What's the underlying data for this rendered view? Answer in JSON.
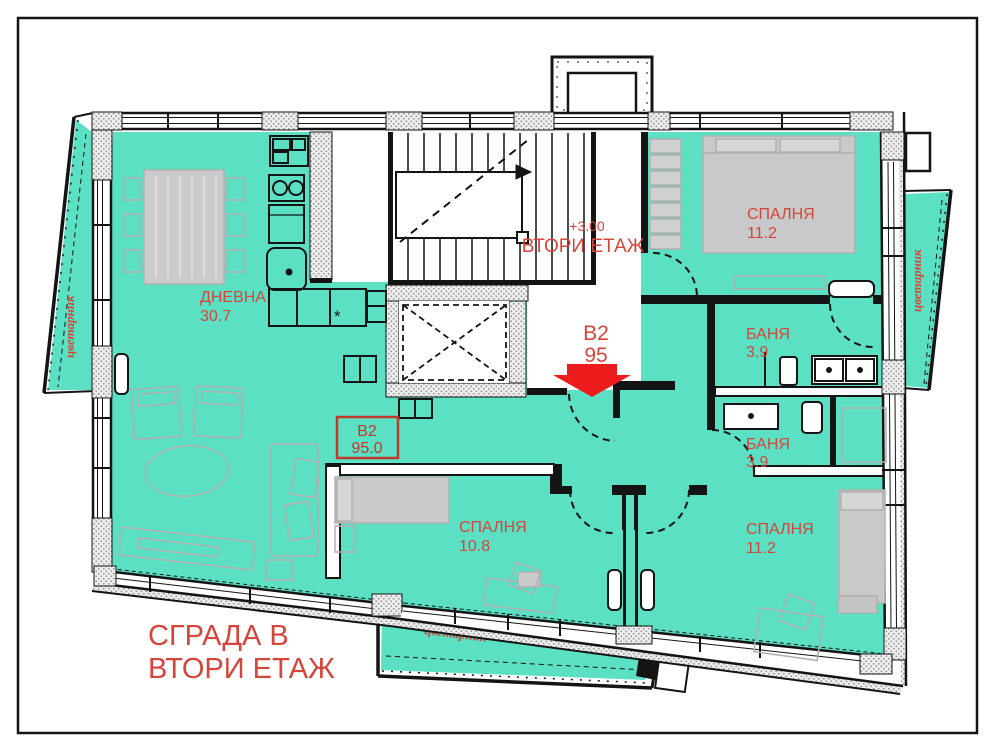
{
  "title": {
    "line1": "СГРАДА В",
    "line2": "ВТОРИ ЕТАЖ"
  },
  "floor_marker": {
    "elevation": "+3.00",
    "floor": "ВТОРИ ЕТАЖ"
  },
  "unit_marker": {
    "id": "B2",
    "area": "95"
  },
  "unit_box": {
    "id": "B2",
    "area": "95.0"
  },
  "rooms": {
    "living": {
      "name": "ДНЕВНА",
      "area": "30.7"
    },
    "bedroom_top": {
      "name": "СПАЛНЯ",
      "area": "11.2"
    },
    "bath_top": {
      "name": "БАНЯ",
      "area": "3.9"
    },
    "bath_bottom": {
      "name": "БАНЯ",
      "area": "3.9"
    },
    "bedroom_mid": {
      "name": "СПАЛНЯ",
      "area": "10.8"
    },
    "bedroom_right": {
      "name": "СПАЛНЯ",
      "area": "11.2"
    }
  },
  "planters": {
    "left": "цветарник",
    "right": "цветарник",
    "bottom": "цветарник"
  },
  "kitchen": {
    "asterisk": "*"
  },
  "colors": {
    "room_fill": "#5be0c4",
    "label_red": "#d6453b",
    "arrow_red": "#ed1c1c",
    "furniture_gray": "#b5b5b5",
    "wall_black": "#141414"
  }
}
